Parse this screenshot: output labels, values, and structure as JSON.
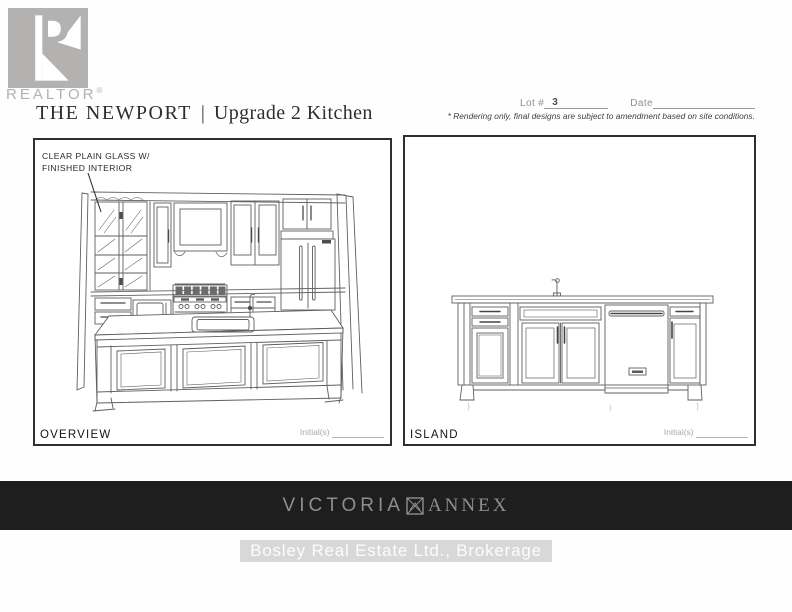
{
  "header": {
    "logo": {
      "brand": "REALTOR",
      "registered": "®"
    },
    "title": {
      "project": "THE NEWPORT",
      "separator": "|",
      "variant": "Upgrade 2 Kitchen"
    },
    "lot": {
      "label": "Lot #",
      "value": "3"
    },
    "date": {
      "label": "Date"
    },
    "disclaimer": "* Rendering only, final designs are subject to amendment based on site conditions."
  },
  "panels": [
    {
      "caption": "OVERVIEW",
      "initials_label": "Initial(s)",
      "annotation": {
        "line1": "CLEAR PLAIN GLASS W/",
        "line2": "FINISHED INTERIOR"
      }
    },
    {
      "caption": "ISLAND",
      "initials_label": "Initial(s)"
    }
  ],
  "footer": {
    "development": {
      "word1": "VICTORIA",
      "word2": "ANNEX"
    },
    "brokerage": "Bosley Real Estate Ltd., Brokerage"
  },
  "colors": {
    "banner_bg": "#1e1e1e",
    "banner_text": "#8e8e8e",
    "logo_gray": "#b4b1b1",
    "line_art": "#5f5f5f"
  }
}
